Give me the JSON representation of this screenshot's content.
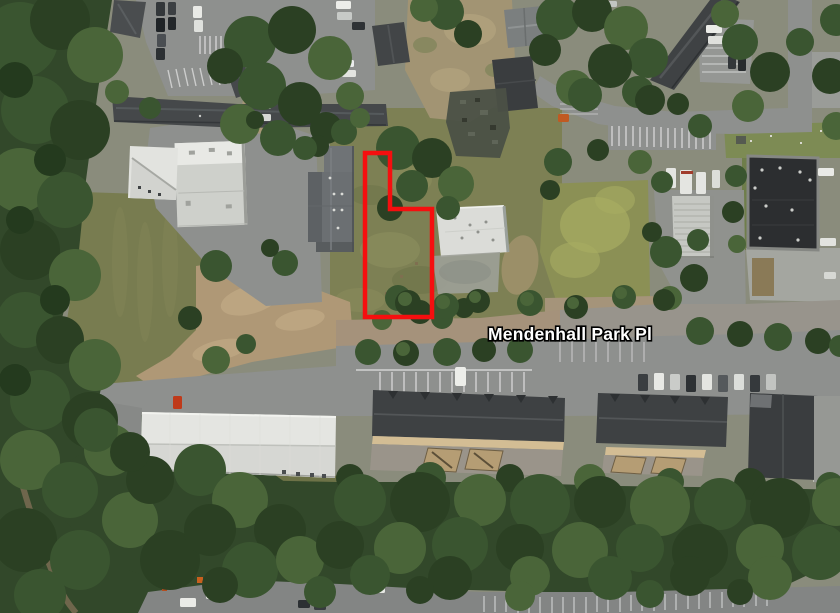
{
  "map": {
    "street_label": {
      "text": "Mendenhall Park Pl"
    },
    "parcel_outline": {
      "points": "365,153 390,153 390,209 432,209 432,317 365,317",
      "color": "#f50f0f",
      "stroke_width": 4.5
    },
    "colors": {
      "parcel": "#f50f0f",
      "label-fill": "#ffffff",
      "label-outline": "#000000"
    }
  }
}
